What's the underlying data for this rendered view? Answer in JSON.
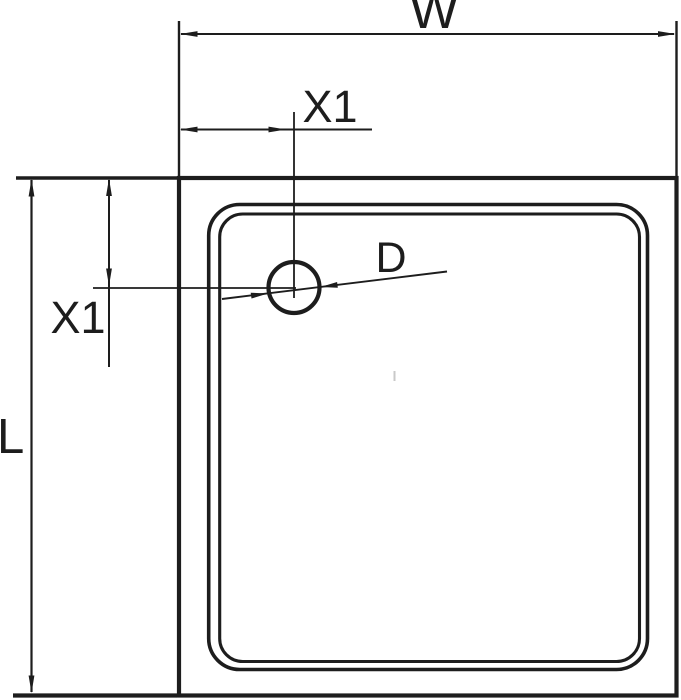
{
  "page": {
    "background": "#ffffff"
  },
  "diagram": {
    "type": "technical-drawing",
    "line_color": "#1d1d1d",
    "artifact_color": "#c9c9c9",
    "labels": {
      "overall_width": "W",
      "overall_length": "L",
      "drain_offset_horizontal": "X1",
      "drain_offset_vertical": "X1",
      "drain_diameter": "D"
    }
  }
}
